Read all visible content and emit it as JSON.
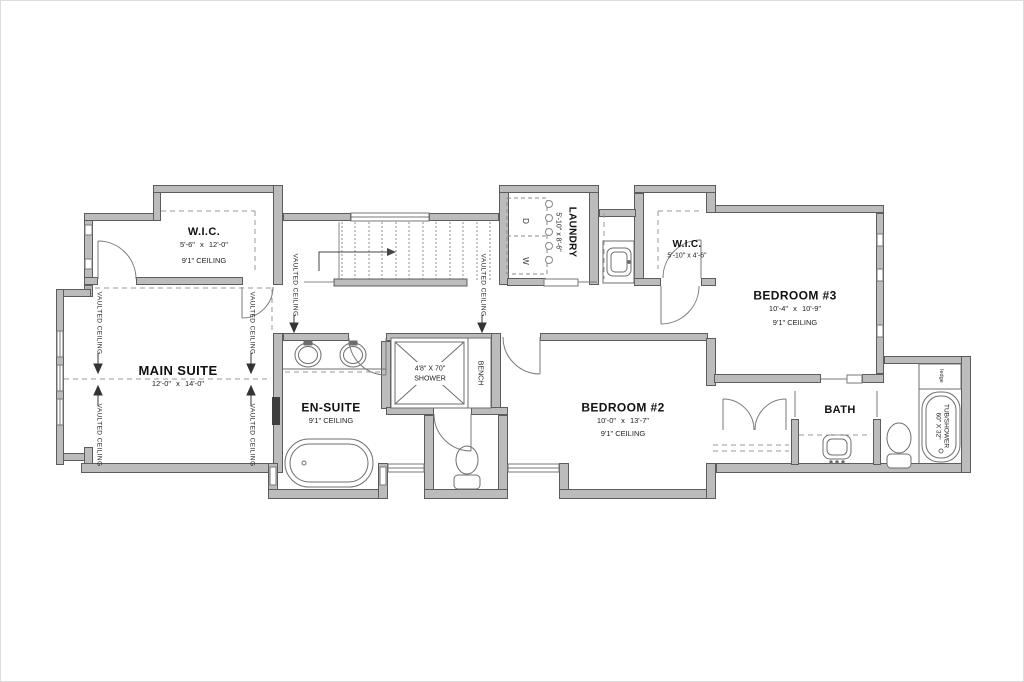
{
  "colors": {
    "wall_fill": "#bcbcbc",
    "wall_edge": "#5c5c5c",
    "fixture_line": "#6e6e6e",
    "dashed_line": "#999999",
    "text": "#111111"
  },
  "rooms": {
    "wic_main": {
      "name": "W.I.C.",
      "dims": "5'-6\" x 12'-0\"",
      "ceiling": "9'1\" CEILING"
    },
    "main_suite": {
      "name": "MAIN SUITE",
      "dims": "12'-0\" x 14'-0\""
    },
    "laundry": {
      "name": "LAUNDRY",
      "dims": "5'-10\" x 8'-6\""
    },
    "wic_2": {
      "name": "W.I.C.",
      "dims": "5'-10\" x 4'-6\""
    },
    "bedroom_3": {
      "name": "BEDROOM #3",
      "dims": "10'-4\" x 10'-9\"",
      "ceiling": "9'1\" CEILING"
    },
    "en_suite": {
      "name": "EN-SUITE",
      "ceiling": "9'1\" CEILING"
    },
    "bedroom_2": {
      "name": "BEDROOM #2",
      "dims": "10'-0\" x 13'-7\"",
      "ceiling": "9'1\" CEILING"
    },
    "bath": {
      "name": "BATH"
    }
  },
  "fixtures": {
    "shower_dims": "4'8\" X 70\"",
    "shower_label": "SHOWER",
    "bench": "BENCH",
    "tub_label": "TUB/SHOWER",
    "tub_dims": "60\" X 32\"",
    "ledge": "ledge",
    "dryer": "D",
    "washer": "W"
  },
  "annotations": {
    "vaulted": "VAULTED CEILING"
  }
}
